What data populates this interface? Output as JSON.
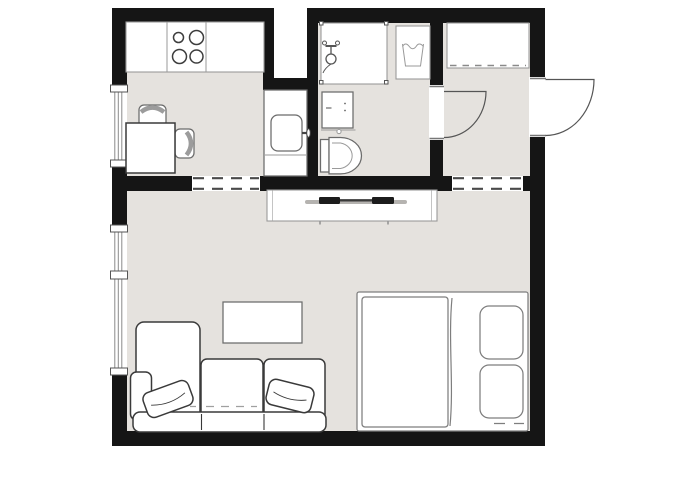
{
  "meta": {
    "kind": "architectural-floor-plan",
    "description": "Top-down floor plan of a studio apartment, monochrome drawing with light gray floors and black walls. No text labels are rendered in the image.",
    "text_labels": []
  },
  "colors": {
    "bg": "#ffffff",
    "floor": "#e5e2de",
    "wall": "#151515",
    "white": "#ffffff",
    "outline-dark": "#3a3a3a",
    "outline-mid": "#6b6b6b",
    "outline-light": "#9a9a9a",
    "sketch": "#7e7e7e",
    "tv": "#1c1c1c",
    "soundbar": "#b5b3b0"
  },
  "floorplan": {
    "rooms": [
      {
        "name": "kitchen",
        "position": "top-left",
        "items": [
          "kitchen counter",
          "stove with 4 burners",
          "dining table",
          "chair (top)",
          "chair (right)",
          "window in left wall"
        ]
      },
      {
        "name": "utility-closet",
        "position": "between kitchen and bathroom",
        "items": [
          "utility sink with faucet",
          "light shaft above"
        ]
      },
      {
        "name": "bathroom",
        "position": "top-center",
        "items": [
          "shower enclosure",
          "washing machine",
          "vanity sink cabinet",
          "toilet",
          "door to hall"
        ]
      },
      {
        "name": "entrance-hall",
        "position": "top-right",
        "items": [
          "wardrobe with hanging rail",
          "entry door swinging outward"
        ]
      },
      {
        "name": "living-room",
        "position": "bottom",
        "items": [
          "tv sideboard with flat tv",
          "coffee table",
          "corner sofa with chaise",
          "2 throw pillows",
          "double bed with duvet",
          "2 bed pillows",
          "tall window in left wall"
        ]
      }
    ],
    "openings": [
      "open passage kitchen to living room (dashed)",
      "open passage hall to living room (dashed)",
      "bathroom door with quarter-circle swing into hall",
      "entry door with quarter-circle swing to outside",
      "kitchen window",
      "living room window with mullions",
      "open light shaft between kitchen and bathroom"
    ],
    "counts": {
      "windows": 2,
      "doors": 2,
      "stove_burners": 4,
      "sofa_pillows": 2,
      "bed_pillows": 2
    }
  }
}
